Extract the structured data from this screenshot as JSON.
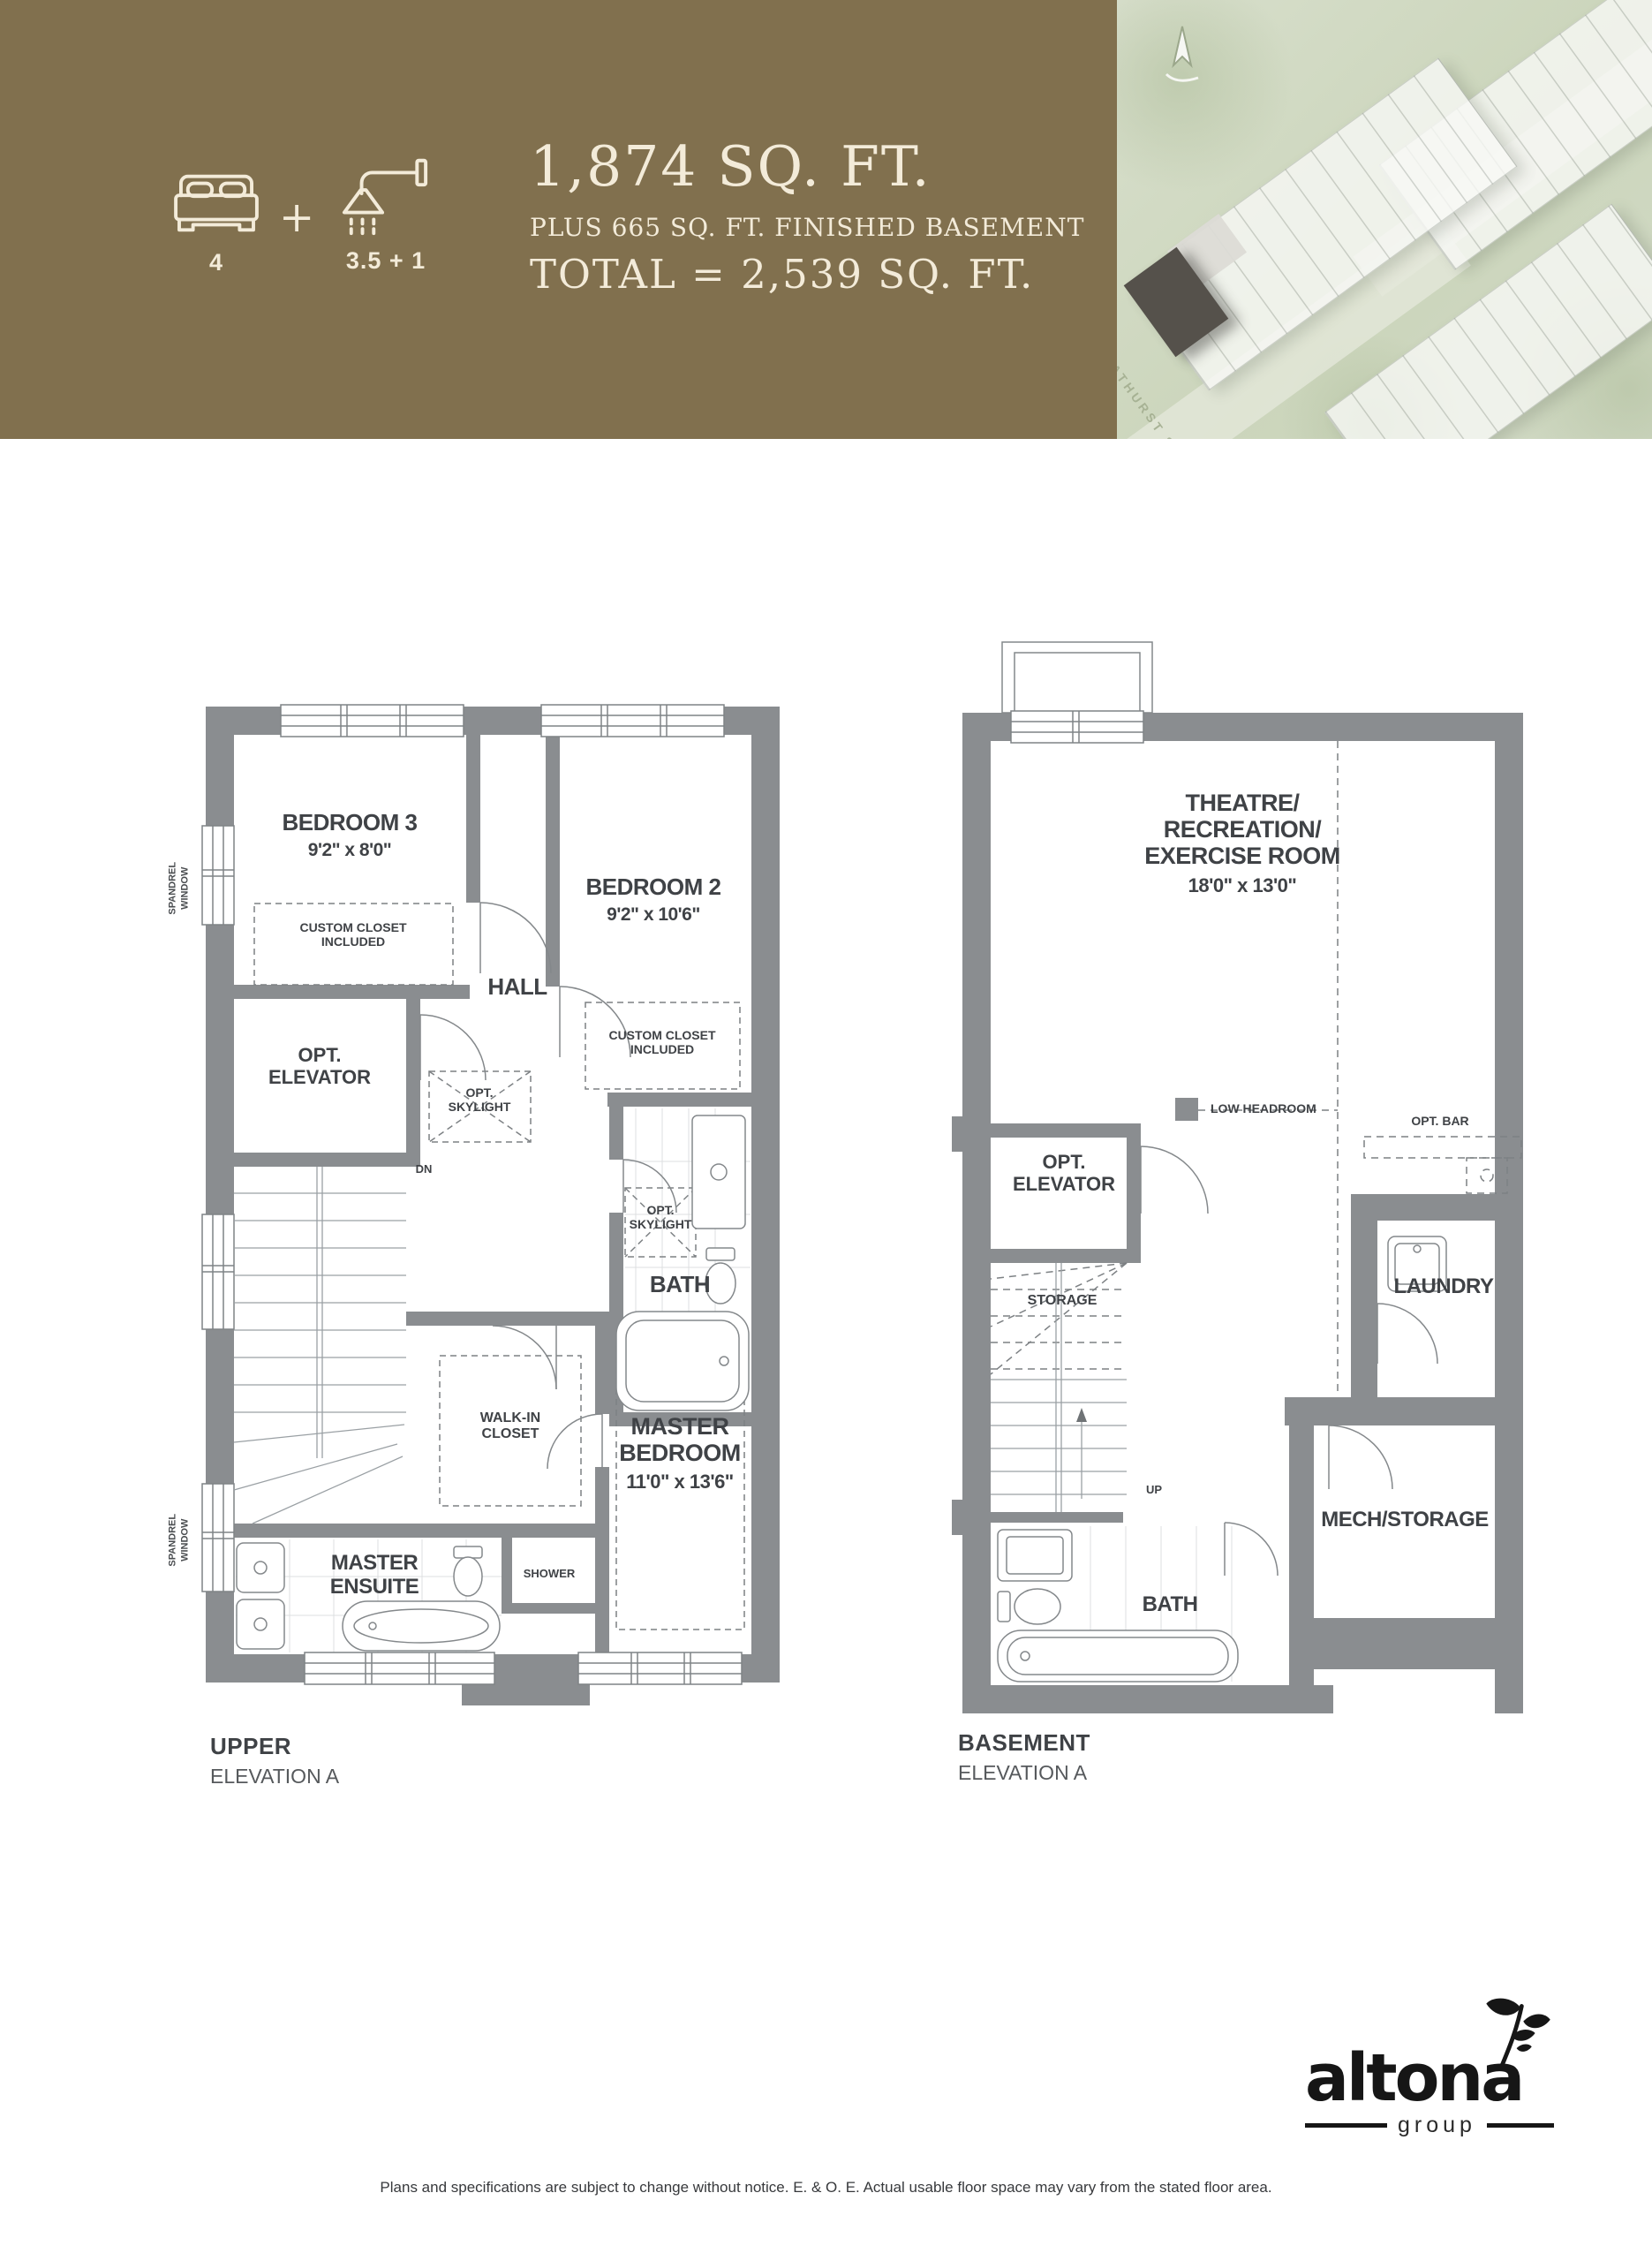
{
  "header": {
    "bed_count": "4",
    "plus_sign": "+",
    "bath_count": "3.5 + 1",
    "title": "1,874 SQ. FT.",
    "subtitle": "PLUS 665 SQ. FT. FINISHED BASEMENT",
    "total": "TOTAL = 2,539 SQ. FT.",
    "band_color": "#81704e",
    "text_color": "#f3ebd9"
  },
  "aerial": {
    "street_label": "BATHURST ST"
  },
  "upper_plan": {
    "caption": "UPPER",
    "elevation": "ELEVATION A",
    "bedroom3": {
      "name": "BEDROOM 3",
      "dims": "9'2\" x 8'0\""
    },
    "bedroom2": {
      "name": "BEDROOM 2",
      "dims": "9'2\" x 10'6\""
    },
    "custom_closet": {
      "l1": "CUSTOM CLOSET",
      "l2": "INCLUDED"
    },
    "opt_elevator": {
      "l1": "OPT.",
      "l2": "ELEVATOR"
    },
    "hall": "HALL",
    "opt_skylight": {
      "l1": "OPT.",
      "l2": "SKYLIGHT"
    },
    "dn": "DN",
    "walk_in_closet": {
      "l1": "WALK-IN",
      "l2": "CLOSET"
    },
    "shower": "SHOWER",
    "master_ensuite": {
      "l1": "MASTER",
      "l2": "ENSUITE"
    },
    "bath": "BATH",
    "master_bedroom": {
      "l1": "MASTER",
      "l2": "BEDROOM",
      "dims": "11'0\" x 13'6\""
    },
    "spandrel_window": {
      "l1": "SPANDREL",
      "l2": "WINDOW"
    }
  },
  "basement_plan": {
    "caption": "BASEMENT",
    "elevation": "ELEVATION A",
    "theatre": {
      "l1": "THEATRE/",
      "l2": "RECREATION/",
      "l3": "EXERCISE ROOM",
      "dims": "18'0\" x 13'0\""
    },
    "low_headroom": "LOW HEADROOM",
    "opt_elevator": {
      "l1": "OPT.",
      "l2": "ELEVATOR"
    },
    "storage": "STORAGE",
    "up": "UP",
    "opt_bar": "OPT. BAR",
    "laundry": "LAUNDRY",
    "mech_storage": "MECH/STORAGE",
    "bath": "BATH"
  },
  "footer": {
    "disclaimer": "Plans and specifications are subject to change without notice.  E. & O. E.  Actual usable floor space may vary from the stated floor area."
  },
  "logo": {
    "name": "altona",
    "tagline": "group"
  },
  "colors": {
    "wall_gray": "#8a8d90",
    "label_dark": "#3f4246",
    "dashed_gray": "#7d8184",
    "brand_brown": "#81704e",
    "cream": "#f3ebd9"
  }
}
